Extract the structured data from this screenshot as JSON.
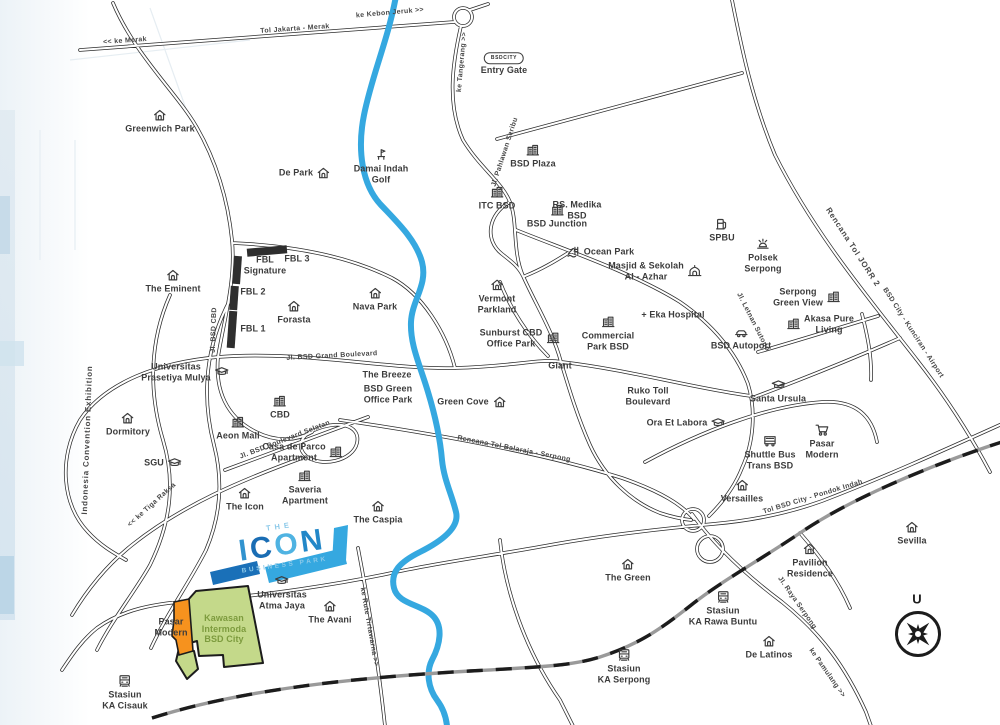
{
  "map": {
    "logo": {
      "the": "THE",
      "letters": [
        {
          "ch": "I",
          "color": "#3193cf"
        },
        {
          "ch": "C",
          "color": "#1a6db4"
        },
        {
          "ch": "O",
          "color": "#4fb3e2"
        },
        {
          "ch": "N",
          "color": "#2287c8"
        }
      ],
      "subtitle": "BUSINESS PARK"
    },
    "compass": {
      "label": "U"
    },
    "entry_gate_badge": "BSDCITY",
    "colors": {
      "river": "#35a8e0",
      "icon_dark": "#1a70b8",
      "icon_light": "#35a8e0",
      "area_green": "#c4d98a",
      "area_orange": "#f6921e",
      "road_line": "#2b2b2b",
      "railway_gray": "#9a9a9a",
      "label_text": "#3c3c3c",
      "green_text": "#7d9b3e"
    },
    "areas": [
      {
        "id": "kawasan-intermoda-area",
        "label": "Kawasan Intermoda BSD City",
        "color": "#c4d98a"
      },
      {
        "id": "pasar-modern-area",
        "label": "Pasar Modern",
        "color": "#f6921e"
      }
    ],
    "pois": [
      {
        "id": "greenwich-park",
        "label": "Greenwich Park",
        "icon": "house",
        "iconpos": "top",
        "x": 160,
        "y": 121
      },
      {
        "id": "de-park",
        "label": "De Park",
        "icon": "house",
        "iconpos": "right",
        "x": 305,
        "y": 173
      },
      {
        "id": "damai-indah-golf",
        "label": "Damai Indah\nGolf",
        "icon": "golf",
        "iconpos": "top",
        "x": 381,
        "y": 166
      },
      {
        "id": "entry-gate",
        "label": "Entry Gate",
        "icon": "badge",
        "iconpos": "top",
        "x": 504,
        "y": 64
      },
      {
        "id": "bsd-plaza",
        "label": "BSD Plaza",
        "icon": "building",
        "iconpos": "top",
        "x": 533,
        "y": 156
      },
      {
        "id": "itc-bsd",
        "label": "ITC BSD",
        "icon": "building",
        "iconpos": "top",
        "x": 497,
        "y": 198
      },
      {
        "id": "rs-medika-bsd",
        "label": "RS. Medika\nBSD",
        "x": 577,
        "y": 210
      },
      {
        "id": "bsd-junction",
        "label": "BSD Junction",
        "icon": "building",
        "iconpos": "top",
        "x": 557,
        "y": 216
      },
      {
        "id": "ocean-park",
        "label": "Ocean Park",
        "icon": "waterpark",
        "iconpos": "left",
        "x": 600,
        "y": 252
      },
      {
        "id": "masjid-sekolah-al-azhar",
        "label": "Masjid & Sekolah\nAl - Azhar",
        "icon": "mosque",
        "iconpos": "right",
        "x": 655,
        "y": 271
      },
      {
        "id": "spbu",
        "label": "SPBU",
        "icon": "gas",
        "iconpos": "top",
        "x": 722,
        "y": 230
      },
      {
        "id": "polsek-serpong",
        "label": "Polsek\nSerpong",
        "icon": "siren",
        "iconpos": "top",
        "x": 763,
        "y": 255
      },
      {
        "id": "serpong-green-view",
        "label": "Serpong\nGreen View",
        "icon": "building",
        "iconpos": "right",
        "x": 807,
        "y": 297
      },
      {
        "id": "akasa-pure-living",
        "label": "Akasa Pure\nLiving",
        "icon": "building",
        "iconpos": "left",
        "x": 820,
        "y": 324
      },
      {
        "id": "eka-hospital",
        "label": "+ Eka Hospital",
        "x": 673,
        "y": 315
      },
      {
        "id": "bsd-autoport",
        "label": "BSD Autoport",
        "icon": "car",
        "iconpos": "top",
        "x": 741,
        "y": 338
      },
      {
        "id": "vermont-parkland",
        "label": "Vermont\nParkland",
        "icon": "house",
        "iconpos": "top",
        "x": 497,
        "y": 296
      },
      {
        "id": "nava-park",
        "label": "Nava Park",
        "icon": "house",
        "iconpos": "top",
        "x": 375,
        "y": 299
      },
      {
        "id": "forasta",
        "label": "Forasta",
        "icon": "house",
        "iconpos": "top",
        "x": 294,
        "y": 312
      },
      {
        "id": "fbl-signature",
        "label": "FBL\nSignature",
        "x": 265,
        "y": 265
      },
      {
        "id": "fbl-3",
        "label": "FBL 3",
        "x": 297,
        "y": 259
      },
      {
        "id": "fbl-2",
        "label": "FBL 2",
        "x": 253,
        "y": 292
      },
      {
        "id": "fbl-1",
        "label": "FBL 1",
        "x": 253,
        "y": 329
      },
      {
        "id": "the-eminent",
        "label": "The Eminent",
        "icon": "house",
        "iconpos": "top",
        "x": 173,
        "y": 281
      },
      {
        "id": "universitas-prasetiya-mulya",
        "label": "Universitas\nPrasetiya Mulya",
        "icon": "gradcap",
        "iconpos": "right",
        "x": 185,
        "y": 372
      },
      {
        "id": "dormitory",
        "label": "Dormitory",
        "icon": "house",
        "iconpos": "top",
        "x": 128,
        "y": 424
      },
      {
        "id": "sgu",
        "label": "SGU",
        "icon": "gradcap",
        "iconpos": "right",
        "x": 163,
        "y": 463
      },
      {
        "id": "cbd",
        "label": "CBD",
        "icon": "building",
        "iconpos": "top",
        "x": 280,
        "y": 407
      },
      {
        "id": "aeon-mall",
        "label": "Aeon Mall",
        "icon": "building",
        "iconpos": "top",
        "x": 238,
        "y": 428
      },
      {
        "id": "casa-de-parco-apartment",
        "label": "Casa de Parco\nApartment",
        "icon": "building",
        "iconpos": "right",
        "x": 303,
        "y": 452
      },
      {
        "id": "saveria-apartment",
        "label": "Saveria\nApartment",
        "icon": "building",
        "iconpos": "top",
        "x": 305,
        "y": 487
      },
      {
        "id": "the-icon",
        "label": "The Icon",
        "icon": "house",
        "iconpos": "top",
        "x": 245,
        "y": 499
      },
      {
        "id": "the-caspia",
        "label": "The Caspia",
        "icon": "house",
        "iconpos": "top",
        "x": 378,
        "y": 512
      },
      {
        "id": "the-breeze",
        "label": "The Breeze",
        "x": 387,
        "y": 375
      },
      {
        "id": "bsd-green-office-park",
        "label": "BSD Green\nOffice Park",
        "x": 388,
        "y": 394
      },
      {
        "id": "green-cove",
        "label": "Green Cove",
        "icon": "house",
        "iconpos": "right",
        "x": 472,
        "y": 402
      },
      {
        "id": "sunburst-cbd-office-park",
        "label": "Sunburst CBD\nOffice Park",
        "icon": "building",
        "iconpos": "right",
        "x": 520,
        "y": 338
      },
      {
        "id": "giant",
        "label": "Giant",
        "x": 560,
        "y": 366
      },
      {
        "id": "commercial-park-bsd",
        "label": "Commercial\nPark BSD",
        "icon": "building",
        "iconpos": "top",
        "x": 608,
        "y": 333
      },
      {
        "id": "ruko-toll-boulevard",
        "label": "Ruko Toll\nBoulevard",
        "x": 648,
        "y": 396
      },
      {
        "id": "ora-et-labora",
        "label": "Ora Et Labora",
        "icon": "gradcap",
        "iconpos": "right",
        "x": 686,
        "y": 423
      },
      {
        "id": "santa-ursula",
        "label": "Santa Ursula",
        "icon": "gradcap",
        "iconpos": "top",
        "x": 778,
        "y": 391
      },
      {
        "id": "pasar-modern-east",
        "label": "Pasar\nModern",
        "icon": "cart",
        "iconpos": "top",
        "x": 822,
        "y": 441
      },
      {
        "id": "shuttle-bus-trans-bsd",
        "label": "Shuttle Bus\nTrans BSD",
        "icon": "bus",
        "iconpos": "top",
        "x": 770,
        "y": 452
      },
      {
        "id": "versailles",
        "label": "Versailles",
        "icon": "house",
        "iconpos": "top",
        "x": 742,
        "y": 491
      },
      {
        "id": "sevilla",
        "label": "Sevilla",
        "icon": "house",
        "iconpos": "top",
        "x": 912,
        "y": 533
      },
      {
        "id": "pavilion-residence",
        "label": "Pavilion\nResidence",
        "icon": "house",
        "iconpos": "top",
        "x": 810,
        "y": 560
      },
      {
        "id": "the-green",
        "label": "The Green",
        "icon": "house",
        "iconpos": "top",
        "x": 628,
        "y": 570
      },
      {
        "id": "stasiun-ka-rawa-buntu",
        "label": "Stasiun\nKA Rawa Buntu",
        "icon": "train",
        "iconpos": "top",
        "x": 723,
        "y": 608
      },
      {
        "id": "de-latinos",
        "label": "De Latinos",
        "icon": "house",
        "iconpos": "top",
        "x": 769,
        "y": 647
      },
      {
        "id": "stasiun-ka-serpong",
        "label": "Stasiun\nKA Serpong",
        "icon": "train",
        "iconpos": "top",
        "x": 624,
        "y": 666
      },
      {
        "id": "stasiun-ka-cisauk",
        "label": "Stasiun\nKA Cisauk",
        "icon": "train",
        "iconpos": "top",
        "x": 125,
        "y": 692
      },
      {
        "id": "pasar-modern-west",
        "label": "Pasar\nModern",
        "x": 171,
        "y": 627
      },
      {
        "id": "kawasan-intermoda-bsd-city",
        "label": "Kawasan\nIntermoda\nBSD City",
        "cls": "green",
        "x": 224,
        "y": 629
      },
      {
        "id": "universitas-atma-jaya",
        "label": "Universitas\nAtma Jaya",
        "icon": "gradcap",
        "iconpos": "top",
        "x": 282,
        "y": 592
      },
      {
        "id": "the-avani",
        "label": "The Avani",
        "icon": "house",
        "iconpos": "top",
        "x": 330,
        "y": 612
      }
    ],
    "road_labels": [
      {
        "id": "tol-jakarta-merak",
        "label": "Tol Jakarta - Merak",
        "x": 295,
        "y": 29,
        "rot": -4
      },
      {
        "id": "ke-merak",
        "label": "<< ke Merak",
        "x": 125,
        "y": 41,
        "rot": -4
      },
      {
        "id": "ke-kebon-jeruk",
        "label": "ke Kebon Jeruk >>",
        "x": 390,
        "y": 13,
        "rot": -5
      },
      {
        "id": "ke-tangerang",
        "label": "ke Tangerang >>",
        "x": 462,
        "y": 62,
        "rot": -85
      },
      {
        "id": "jl-pahlawan-seribu",
        "label": "Jl. Pahlawan Seribu",
        "x": 505,
        "y": 152,
        "rot": -72
      },
      {
        "id": "rencana-tol-jorr-2",
        "label": "Rencana Tol JORR 2",
        "x": 853,
        "y": 247,
        "rot": 57,
        "big": true
      },
      {
        "id": "bsd-city-kunciran-airport",
        "label": "BSD City - Kunciran - Airport",
        "x": 913,
        "y": 333,
        "rot": 57
      },
      {
        "id": "jl-letnan-sutopo",
        "label": "Jl. Letnan Sutopo",
        "x": 753,
        "y": 322,
        "rot": 63
      },
      {
        "id": "jl-bsd-grand-boulevard",
        "label": "Jl. BSD Grand Boulevard",
        "x": 332,
        "y": 356,
        "rot": -3
      },
      {
        "id": "rencana-tol-balaraja-serpong",
        "label": "Rencana Tol Balaraja - Serpong",
        "x": 514,
        "y": 449,
        "rot": 11
      },
      {
        "id": "jl-bsd-boulevard-selatan",
        "label": "Jl. BSD Boulevard Selatan",
        "x": 285,
        "y": 440,
        "rot": -21
      },
      {
        "id": "ke-tiga-raksa",
        "label": "<< ke Tiga Raksa",
        "x": 152,
        "y": 505,
        "rot": -42
      },
      {
        "id": "tol-bsd-city-pondok-indah",
        "label": "Tol BSD City - Pondok Indah",
        "x": 813,
        "y": 497,
        "rot": -17
      },
      {
        "id": "jl-raya-serpong",
        "label": "Jl. Raya Serpong",
        "x": 797,
        "y": 603,
        "rot": 55
      },
      {
        "id": "ke-pamulang",
        "label": "ke Pamulang >>",
        "x": 827,
        "y": 673,
        "rot": 55
      },
      {
        "id": "ke-rute-tirtawarna",
        "label": "ke Rute Tirtawarna >>",
        "x": 369,
        "y": 627,
        "rot": 80
      },
      {
        "id": "jl-bsd-cbd",
        "label": "Jl. BSD CBD",
        "x": 214,
        "y": 330,
        "rot": -88
      },
      {
        "id": "indonesia-convention-exhibition",
        "label": "Indonesia Convention Exhibition",
        "x": 87,
        "y": 440,
        "rot": -88,
        "big": true
      }
    ]
  }
}
